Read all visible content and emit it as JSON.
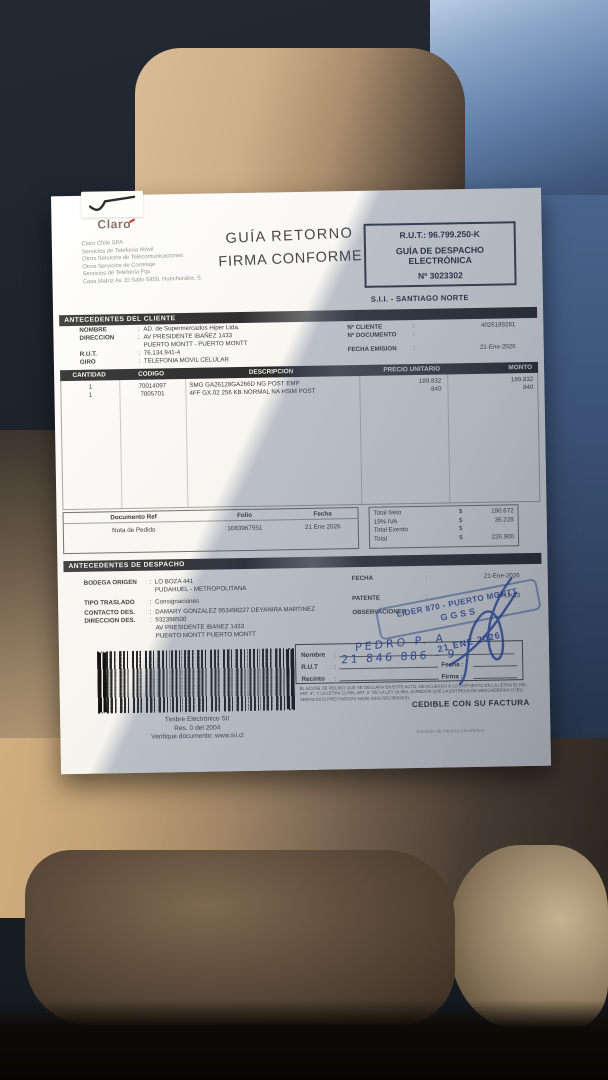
{
  "paper": {
    "brand": "Claro",
    "supplier_lines": [
      "Claro Chile SPA",
      "Servicios de Telefonía Móvil",
      "Otros Servicios de Telecomunicaciones",
      "Otros Servicios de Corretaje",
      "Servicios de Telefonía Fija",
      "Casa Matriz Av. El Salto 5450, Huechuraba, S."
    ],
    "return_label": {
      "line1": "GUÍA RETORNO",
      "line2": "FIRMA CONFORME"
    },
    "rut_box": {
      "rut": "R.U.T.: 96.799.250-K",
      "type1": "GUÍA DE DESPACHO",
      "type2": "ELECTRÓNICA",
      "number": "Nº 3023302"
    },
    "sii_office": "S.I.I. - SANTIAGO NORTE",
    "client": {
      "title": "ANTECEDENTES DEL CLIENTE",
      "rows": [
        {
          "label": "NOMBRE",
          "sep": ":",
          "value": "AD. de Supermercados Hiper Ltda."
        },
        {
          "label": "DIRECCION",
          "sep": ":",
          "value": "AV PRESIDENTE IBAÑEZ 1433"
        },
        {
          "label": "",
          "sep": "",
          "value": "PUERTO MONTT -  PUERTO MONTT"
        },
        {
          "label": "R.U.T.",
          "sep": ":",
          "value": "76.134.941-4"
        },
        {
          "label": "GIRO",
          "sep": ":",
          "value": "TELEFONIA MOVIL CELULAR"
        }
      ],
      "right_rows": [
        {
          "label": "Nº CLIENTE",
          "sep": ":",
          "value": "4026189281"
        },
        {
          "label": "Nº DOCUMENTO",
          "sep": ":",
          "value": ""
        },
        {
          "label": "FECHA EMISION",
          "sep": ":",
          "value": "21-Ene-2026"
        }
      ]
    },
    "items": {
      "headers": [
        "CANTIDAD",
        "CODIGO",
        "DESCRIPCION",
        "PRECIO UNITARIO",
        "MONTO"
      ],
      "rows": [
        {
          "qty": "1",
          "code": "70014097",
          "desc": "SMG GA26128GA266D NG POST EMP",
          "price": "189.832",
          "amount": "189.832"
        },
        {
          "qty": "1",
          "code": "7005701",
          "desc": "4FF GX.02 256 KB NORMAL NA HSIM POST",
          "price": "840",
          "amount": "840"
        }
      ]
    },
    "refbox": {
      "h_doc": "Documento Ref",
      "h_folio": "Folio",
      "h_fecha": "Fecha",
      "doc": "Nota de Pedido",
      "folio": "1083967551",
      "fecha": "21 Ene 2026"
    },
    "totals": {
      "rows": [
        {
          "label": "Total Neto",
          "cur": "$",
          "value": "190.672"
        },
        {
          "label": "19% IVA",
          "cur": "$",
          "value": "36.228"
        },
        {
          "label": "Total Exento",
          "cur": "$",
          "value": ""
        },
        {
          "label": "Total",
          "cur": "$",
          "value": "226.900"
        }
      ]
    },
    "dispatch": {
      "title": "ANTECEDENTES DE DESPACHO",
      "rows": [
        {
          "label": "BODEGA ORIGEN",
          "sep": ":",
          "value": "LO BOZA 441"
        },
        {
          "label": "",
          "sep": "",
          "value": "PUDAHUEL - METROPOLITANA"
        },
        {
          "label": "TIPO TRASLADO",
          "sep": ":",
          "value": "Consignaciones"
        },
        {
          "label": "CONTACTO DES.",
          "sep": ":",
          "value": "DAMARY GONZALEZ 953498227 DEYANIRA MARTINEZ"
        },
        {
          "label": "DIRECCION DES.",
          "sep": ":",
          "value": "932398500"
        },
        {
          "label": "",
          "sep": "",
          "value": "AV PRESIDENTE IBANEZ 1433"
        },
        {
          "label": "",
          "sep": "",
          "value": "PUERTO MONTT   PUERTO MONTT"
        }
      ],
      "right_rows": [
        {
          "label": "FECHA",
          "sep": ":",
          "value": "21-Ene-2026"
        },
        {
          "label": "PATENTE",
          "sep": ":",
          "value": "HHJK63"
        },
        {
          "label": "OBSERVACIONES",
          "sep": "",
          "value": ""
        }
      ]
    },
    "stamp": {
      "line1": "LIDER 870 - PUERTO MONTT",
      "line2": "GGSS"
    },
    "date_stamp": "21 ENE 2026",
    "receipt": {
      "sep": ":",
      "labels": [
        "Nombre",
        "R.U.T",
        "Recinto"
      ],
      "fecha_label": "Fecha :",
      "firma_label": "Firma :",
      "hand_name": "PEDRO P. A",
      "hand_rut": "21 846 886 - 9"
    },
    "legal": "EL ACUSE DE RECIBO QUE SE DECLARA EN ESTE ACTO, DE ACUERDO A LO DISPUESTO EN LA LETRA B) DEL ART. 4°, Y LA LETRA C) DEL ART. 5° DE LA LEY 19.983, ACREDITA QUE LA ENTREGA DE MERCADERIAS O (EL) SERVICIO(S) PRESTADO(S) HA(N) SIDO RECIBIDO(S).",
    "cedible": "CEDIBLE CON SU FACTURA",
    "timbre": [
      "Timbre Electrónico SII",
      "Res. 0 del 2004",
      "Verifique documento: www.sii.cl"
    ],
    "footer_note": "Solución de Factura Electrónica"
  },
  "colors": {
    "stamp_blue": "#2b4a9e",
    "ink_blue": "#2646a0",
    "header_bar": "#353535"
  }
}
